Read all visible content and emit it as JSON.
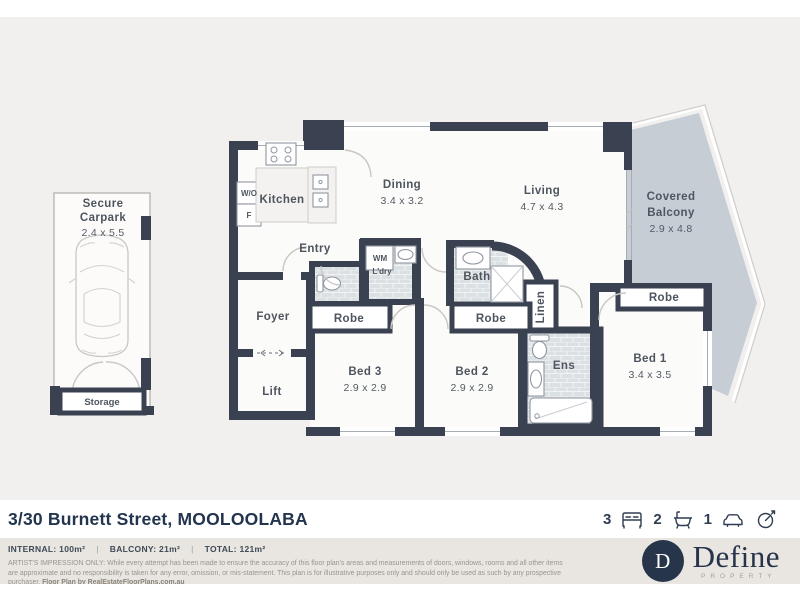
{
  "plan": {
    "rooms": {
      "carpark": {
        "line1": "Secure",
        "line2": "Carpark",
        "dims": "2.4 x 5.5"
      },
      "storage": {
        "label": "Storage"
      },
      "kitchen": {
        "label": "Kitchen"
      },
      "wall_oven": {
        "label": "W/O"
      },
      "fridge": {
        "label": "F"
      },
      "entry": {
        "label": "Entry"
      },
      "dining": {
        "label": "Dining",
        "dims": "3.4 x 3.2"
      },
      "living": {
        "label": "Living",
        "dims": "4.7 x 4.3"
      },
      "balcony": {
        "line1": "Covered",
        "line2": "Balcony",
        "dims": "2.9 x 4.8"
      },
      "laundry": {
        "line1": "WM",
        "line2": "L'dry"
      },
      "foyer": {
        "label": "Foyer"
      },
      "lift": {
        "label": "Lift"
      },
      "bath": {
        "label": "Bath"
      },
      "linen": {
        "label": "Linen"
      },
      "ens": {
        "label": "Ens"
      },
      "bed1": {
        "label": "Bed 1",
        "dims": "3.4 x 3.5"
      },
      "bed2": {
        "label": "Bed 2",
        "dims": "2.9 x 2.9"
      },
      "bed3": {
        "label": "Bed 3",
        "dims": "2.9 x 2.9"
      },
      "robe1": {
        "label": "Robe"
      },
      "robe2": {
        "label": "Robe"
      },
      "robe3": {
        "label": "Robe"
      }
    }
  },
  "footer": {
    "address_street": "3/30 Burnett Street, ",
    "address_suburb": "MOOLOOLABA",
    "stats": {
      "beds": "3",
      "baths": "2",
      "cars": "1"
    },
    "areas": {
      "internal": "INTERNAL: 100m²",
      "balcony": "BALCONY: 21m²",
      "total": "TOTAL: 121m²",
      "separator": "|"
    },
    "disclaimer_line1": "ARTIST'S IMPRESSION ONLY: While every attempt has been made to ensure the accuracy of this floor plan's areas and measurements of doors, windows, rooms and all other items are approximate and no responsibility is taken",
    "disclaimer_line2": "for any error, omission, or mis-statement. This plan is for illustrative purposes only and should only be used as such by any prospective purchaser. ",
    "disclaimer_credit": "Floor Plan by RealEstateFloorPlans.com.au",
    "logo": {
      "initial": "D",
      "name": "Define",
      "tagline": "PROPERTY"
    }
  },
  "colors": {
    "wall": "#3a4150",
    "balcony_fill": "#c6cdd5",
    "background": "#f1f0ee",
    "band": "#e9e6e1",
    "navy": "#2e3d52"
  }
}
